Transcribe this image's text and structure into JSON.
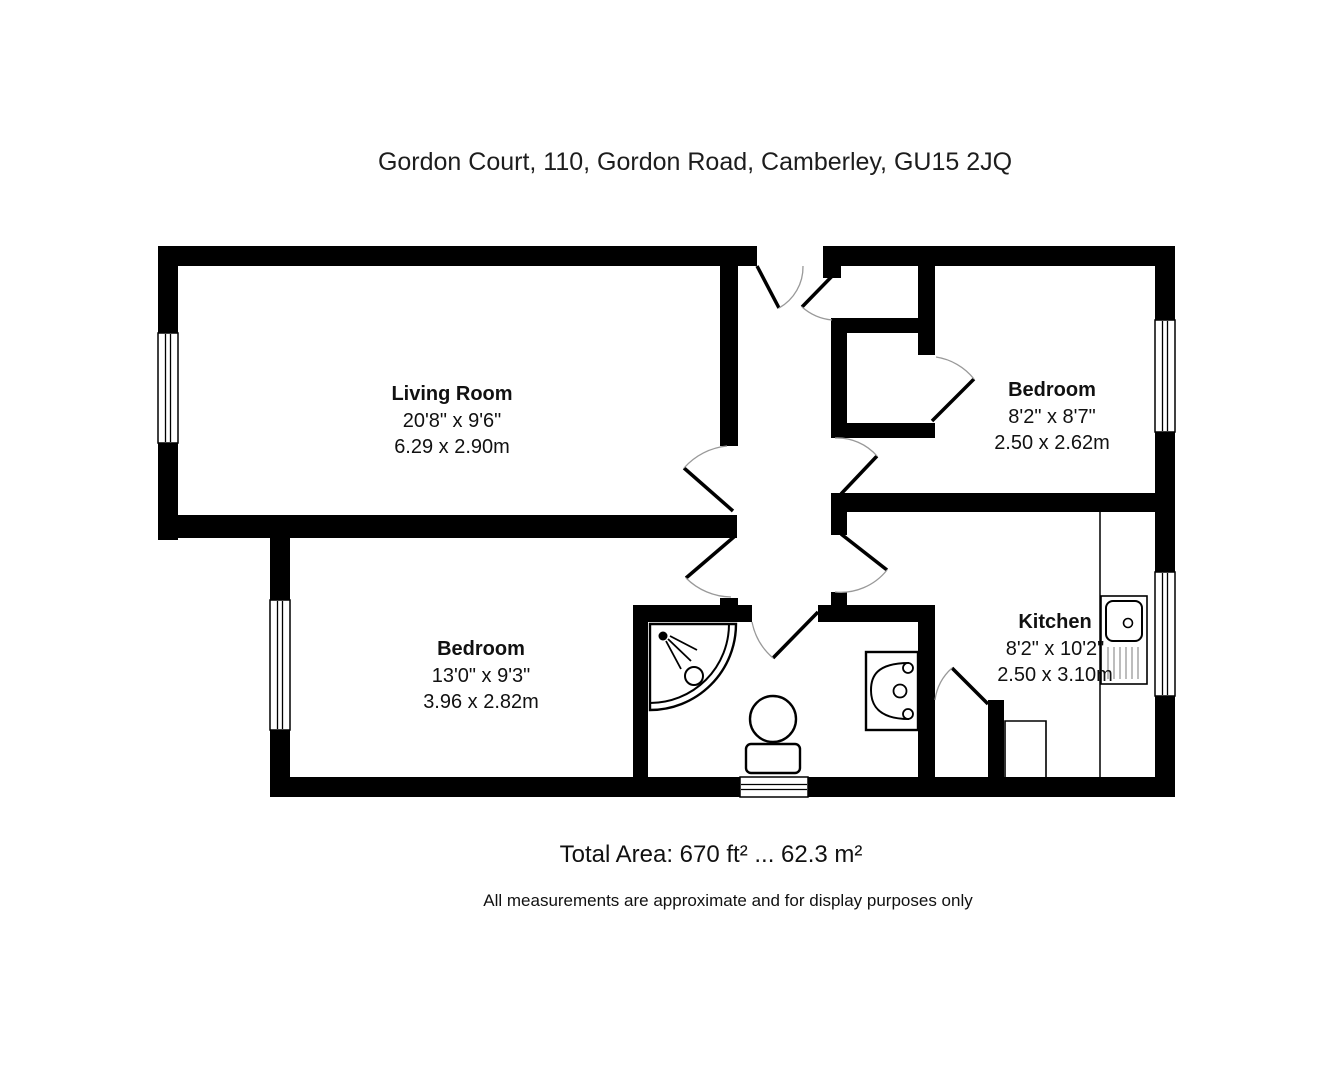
{
  "title": "Gordon Court, 110, Gordon Road, Camberley, GU15 2JQ",
  "rooms": {
    "living_room": {
      "name": "Living Room",
      "dims_imperial": "20'8\" x 9'6\"",
      "dims_metric": "6.29 x 2.90m"
    },
    "bedroom_right": {
      "name": "Bedroom",
      "dims_imperial": "8'2\" x 8'7\"",
      "dims_metric": "2.50 x 2.62m"
    },
    "bedroom_left": {
      "name": "Bedroom",
      "dims_imperial": "13'0\" x 9'3\"",
      "dims_metric": "3.96 x 2.82m"
    },
    "kitchen": {
      "name": "Kitchen",
      "dims_imperial": "8'2\" x 10'2\"",
      "dims_metric": "2.50 x 3.10m"
    }
  },
  "footer": {
    "total_area": "Total Area: 670 ft² ... 62.3 m²",
    "disclaimer": "All measurements are approximate and for display purposes only"
  },
  "fixtures": [
    "corner-shower",
    "toilet",
    "wash-basin",
    "kitchen-sink-drainer",
    "worktop"
  ],
  "colors": {
    "walls": "#000000",
    "background": "#ffffff",
    "text": "#1d1d1d",
    "door_arc": "#999999"
  }
}
